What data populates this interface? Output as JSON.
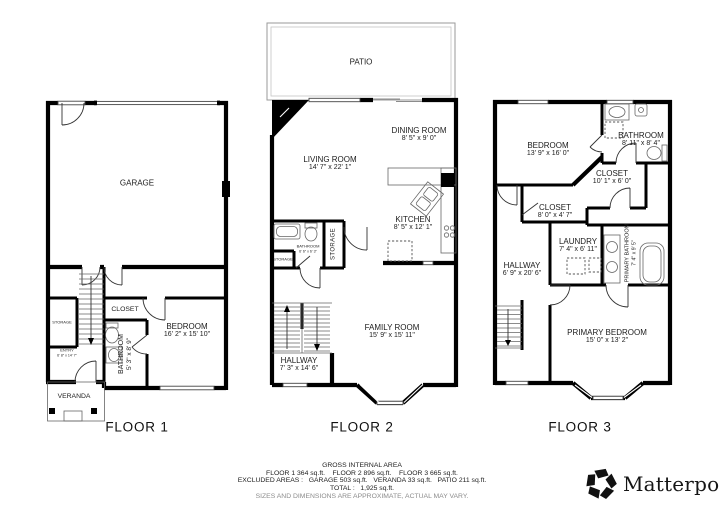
{
  "floors": [
    {
      "title": "FLOOR 1",
      "rooms": {
        "garage": {
          "name": "GARAGE"
        },
        "closet": {
          "name": "CLOSET"
        },
        "bedroom": {
          "name": "BEDROOM",
          "dims": "16' 2\" x 15' 10\""
        },
        "bathroom": {
          "name": "BATHROOM",
          "dims": "5' 3\" x 8' 9\""
        },
        "storage": {
          "name": "STORAGE"
        },
        "entry": {
          "name": "ENTRY",
          "dims": "6' 8\" x 14' 7\""
        },
        "veranda": {
          "name": "VERANDA"
        }
      }
    },
    {
      "title": "FLOOR 2",
      "rooms": {
        "patio": {
          "name": "PATIO"
        },
        "dining": {
          "name": "DINING ROOM",
          "dims": "8' 5\" x 9' 0\""
        },
        "living": {
          "name": "LIVING ROOM",
          "dims": "14' 7\" x 22' 1\""
        },
        "kitchen": {
          "name": "KITCHEN",
          "dims": "8' 5\" x 12' 1\""
        },
        "bathroom": {
          "name": "BATHROOM",
          "dims": "6' 6\" x 6' 3\""
        },
        "storage_tall": {
          "name": "STORAGE"
        },
        "storage_small": {
          "name": "STORAGE"
        },
        "family": {
          "name": "FAMILY ROOM",
          "dims": "15' 9\" x 15' 11\""
        },
        "hallway": {
          "name": "HALLWAY",
          "dims": "7' 3\" x 14' 6\""
        }
      }
    },
    {
      "title": "FLOOR 3",
      "rooms": {
        "bedroom": {
          "name": "BEDROOM",
          "dims": "13' 9\" x 16' 0\""
        },
        "bathroom": {
          "name": "BATHROOM",
          "dims": "8' 11\" x 8' 4\""
        },
        "closet_large": {
          "name": "CLOSET",
          "dims": "10' 1\" x 6' 0\""
        },
        "closet_small": {
          "name": "CLOSET",
          "dims": "8' 0\" x 4' 7\""
        },
        "laundry": {
          "name": "LAUNDRY",
          "dims": "7' 4\" x 6' 11\""
        },
        "hallway": {
          "name": "HALLWAY",
          "dims": "6' 9\" x 20' 6\""
        },
        "primary_bathroom": {
          "name": "PRIMARY BATHROOM",
          "dims": "7' 4\" x 9' 5\""
        },
        "primary_bedroom": {
          "name": "PRIMARY BEDROOM",
          "dims": "15' 0\" x 13' 2\""
        }
      }
    }
  ],
  "footer": {
    "heading": "GROSS INTERNAL AREA",
    "line1": "FLOOR 1 364 sq.ft.    FLOOR 2 896 sq.ft.    FLOOR 3 665 sq.ft.",
    "line2": "EXCLUDED AREAS :   GARAGE 503 sq.ft.   VERANDA 33 sq.ft.   PATIO 211 sq.ft.",
    "line3": "TOTAL :   1,925 sq.ft.",
    "disclaimer": "SIZES AND DIMENSIONS ARE APPROXIMATE, ACTUAL MAY VARY."
  },
  "logo": {
    "text": "Matterport",
    "mark": "™"
  }
}
